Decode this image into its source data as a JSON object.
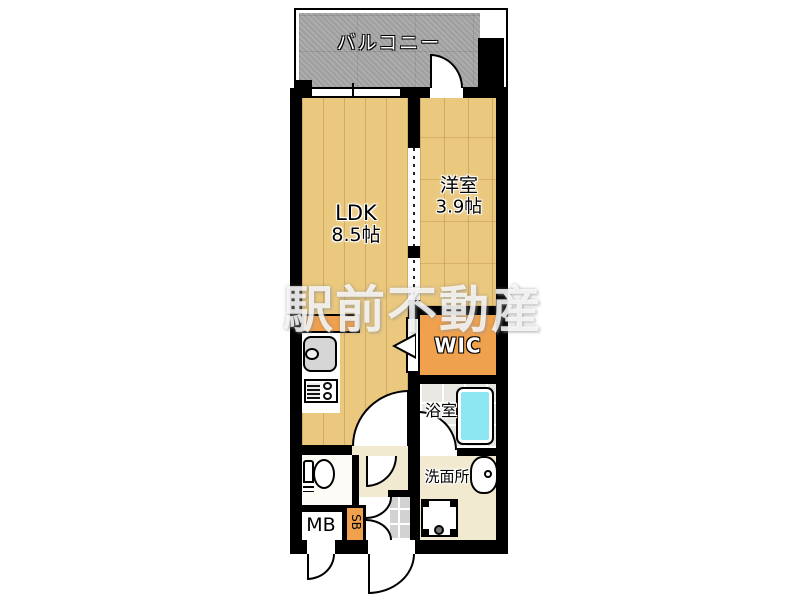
{
  "watermark": "駅前不動産",
  "colors": {
    "wood": "#eac87e",
    "accent-orange": "#f0a14d",
    "balcony-gray": "#a8a8a8",
    "tub-cyan": "#8ce7f2",
    "cream": "#f2ead0",
    "tile-gray": "#d2d2d2"
  },
  "rooms": {
    "balcony": {
      "label": "バルコニー"
    },
    "ldk": {
      "label": "LDK",
      "size": "8.5帖"
    },
    "bedroom": {
      "label": "洋室",
      "size": "3.9帖"
    },
    "wic": {
      "label": "WIC"
    },
    "bathroom": {
      "label": "浴室"
    },
    "washroom": {
      "label": "洗面所"
    },
    "meter_box": {
      "label": "MB"
    },
    "shoe_box": {
      "label": "SB"
    }
  }
}
